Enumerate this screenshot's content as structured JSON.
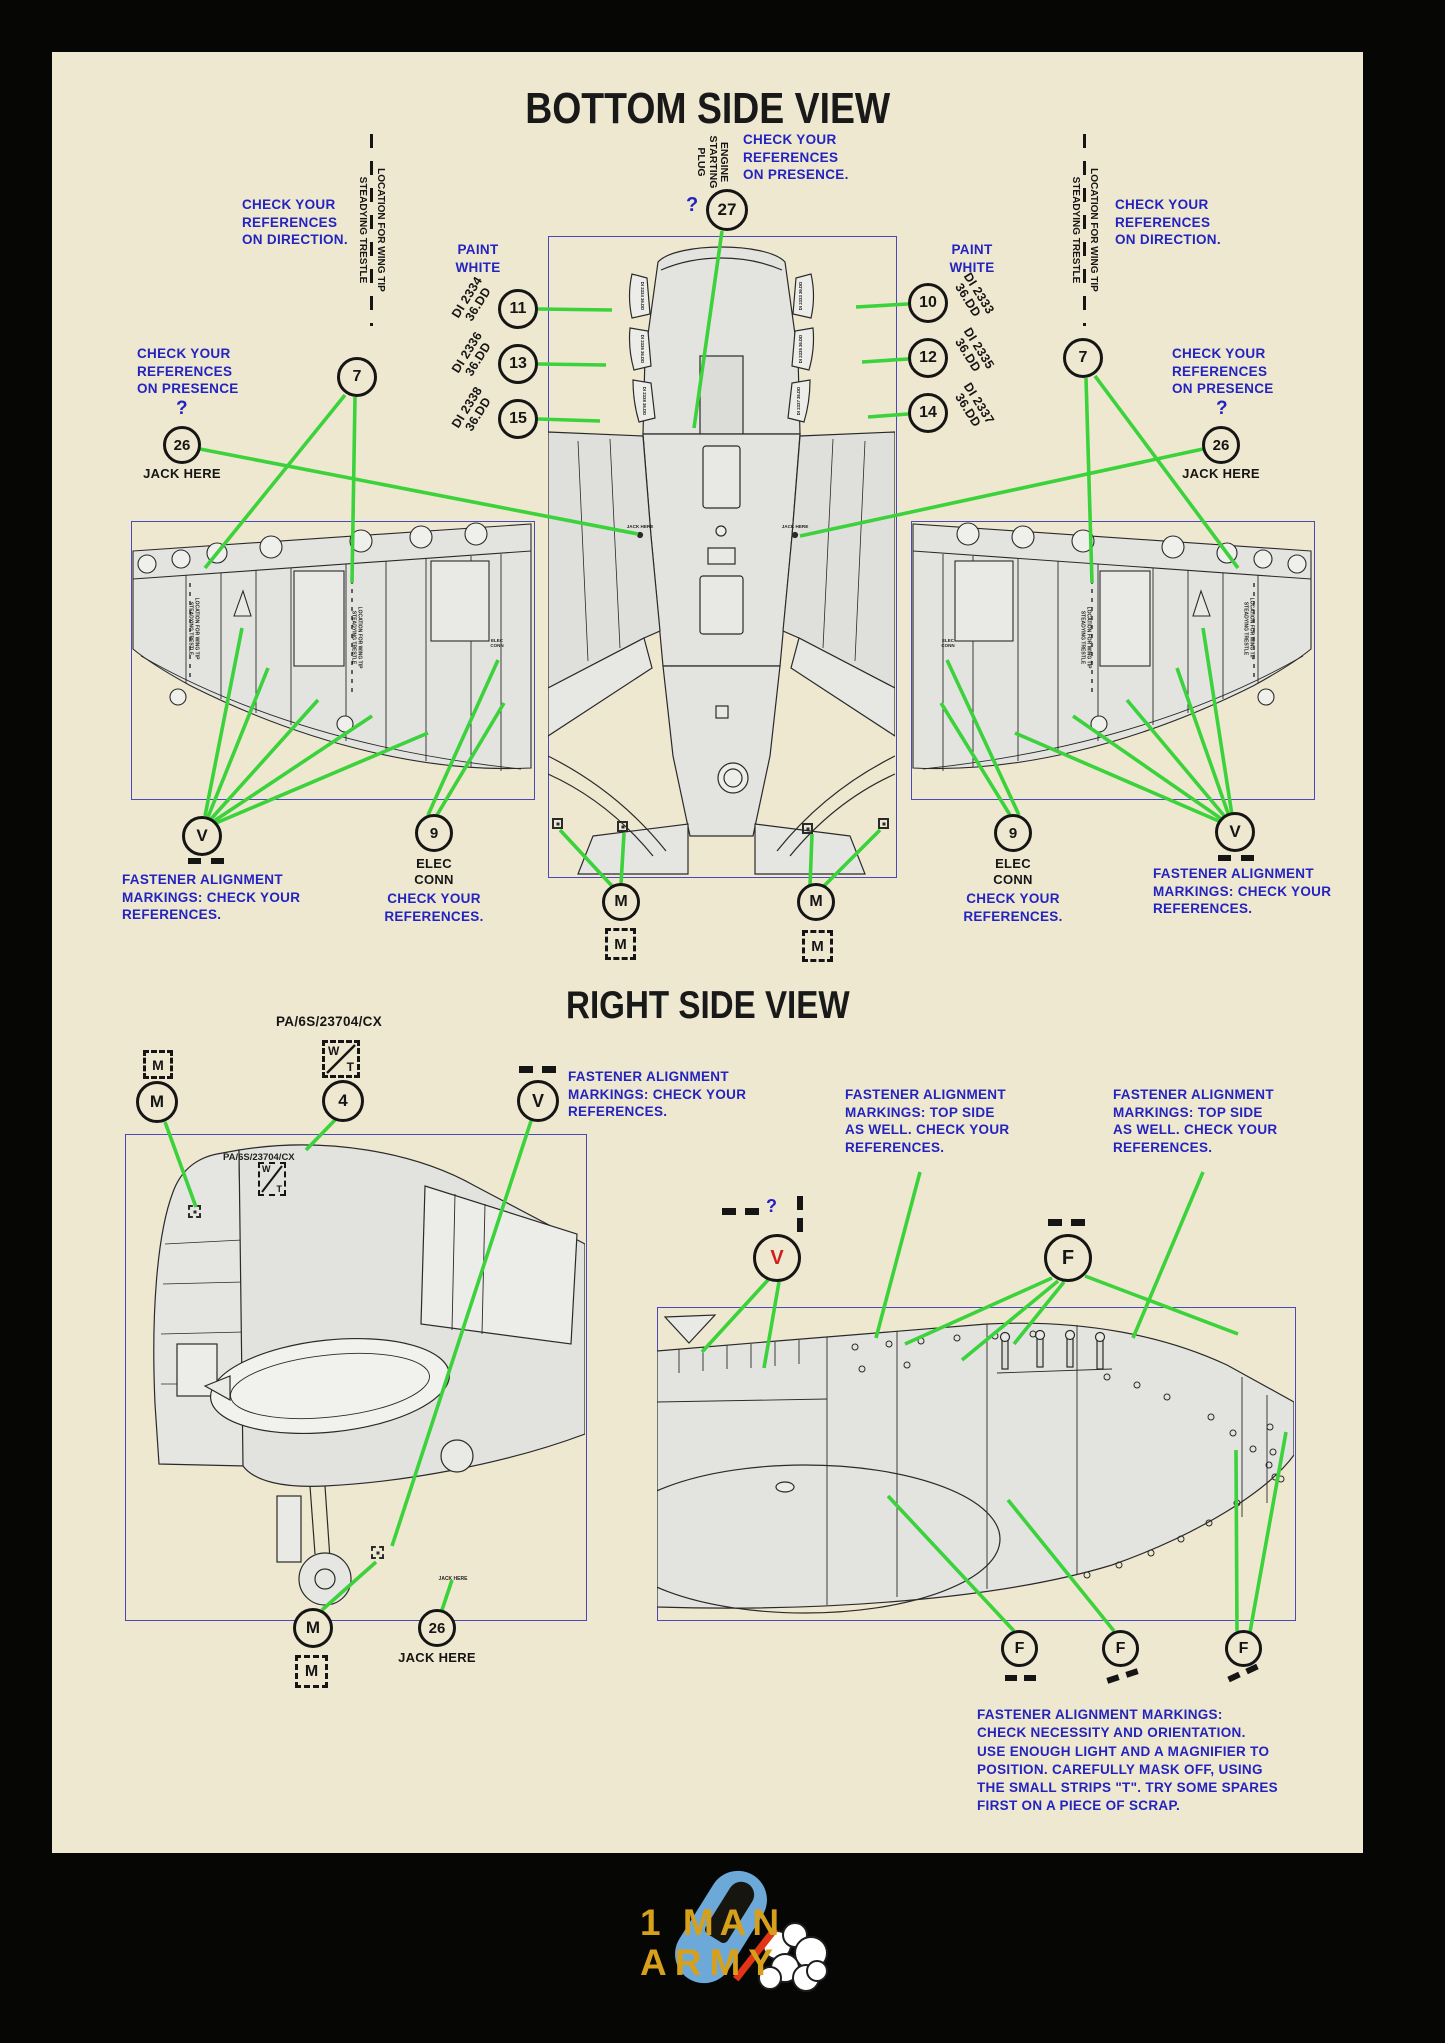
{
  "page": {
    "section1_title": "BOTTOM SIDE VIEW",
    "section2_title": "RIGHT SIDE VIEW"
  },
  "notes": {
    "check_direction": "CHECK YOUR\nREFERENCES\nON DIRECTION.",
    "check_presence": "CHECK YOUR\nREFERENCES\nON PRESENCE",
    "check_presence_dot": "CHECK YOUR\nREFERENCES\nON PRESENCE.",
    "question_mark": "?",
    "paint_white": "PAINT\nWHITE",
    "jack_here": "JACK HERE",
    "elec_conn": "ELEC\nCONN",
    "check_refs": "CHECK YOUR\nREFERENCES.",
    "fastener_check": "FASTENER ALIGNMENT\nMARKINGS: CHECK YOUR\nREFERENCES.",
    "fastener_topside": "FASTENER ALIGNMENT\nMARKINGS: TOP SIDE\nAS WELL. CHECK YOUR\nREFERENCES.",
    "fastener_para": "FASTENER ALIGNMENT MARKINGS:\nCHECK NECESSITY AND ORIENTATION.\nUSE ENOUGH LIGHT AND A MAGNIFIER TO\nPOSITION. CAREFULLY MASK OFF, USING\nTHE SMALL STRIPS \"T\". TRY SOME SPARES\nFIRST ON A PIECE OF SCRAP.",
    "engine_plug": "ENGINE\nSTARTING\nPLUG",
    "trestle_top": "LOCATION FOR WING TIP",
    "trestle_bottom": "STEADYING TRESTLE",
    "pa_code": "PA/6S/23704/CX"
  },
  "callouts": {
    "n27": "27",
    "n11": "11",
    "n13": "13",
    "n15": "15",
    "n10": "10",
    "n12": "12",
    "n14": "14",
    "n7": "7",
    "n26": "26",
    "n9": "9",
    "n4": "4",
    "m": "M",
    "v": "V",
    "f": "F",
    "w": "W",
    "t": "T"
  },
  "stencils": {
    "di2334": "DI 2334\n36.DD",
    "di2336": "DI 2336\n36.DD",
    "di2338": "DI 2338\n36.DD",
    "di2333": "DI 2333\n36.DD",
    "di2335": "DI 2335\n36.DD",
    "di2337": "DI 2337\n36.DD"
  },
  "logo": {
    "line1": "1 MAN",
    "line2": "ARMY"
  },
  "colors": {
    "paper": "#EFE8D0",
    "annotation_blue": "#2323C0",
    "leader_green": "#3BD23B",
    "callout_red": "#CC2020",
    "logo_gold": "#D7A01B",
    "logo_blue": "#6CA9D9"
  }
}
